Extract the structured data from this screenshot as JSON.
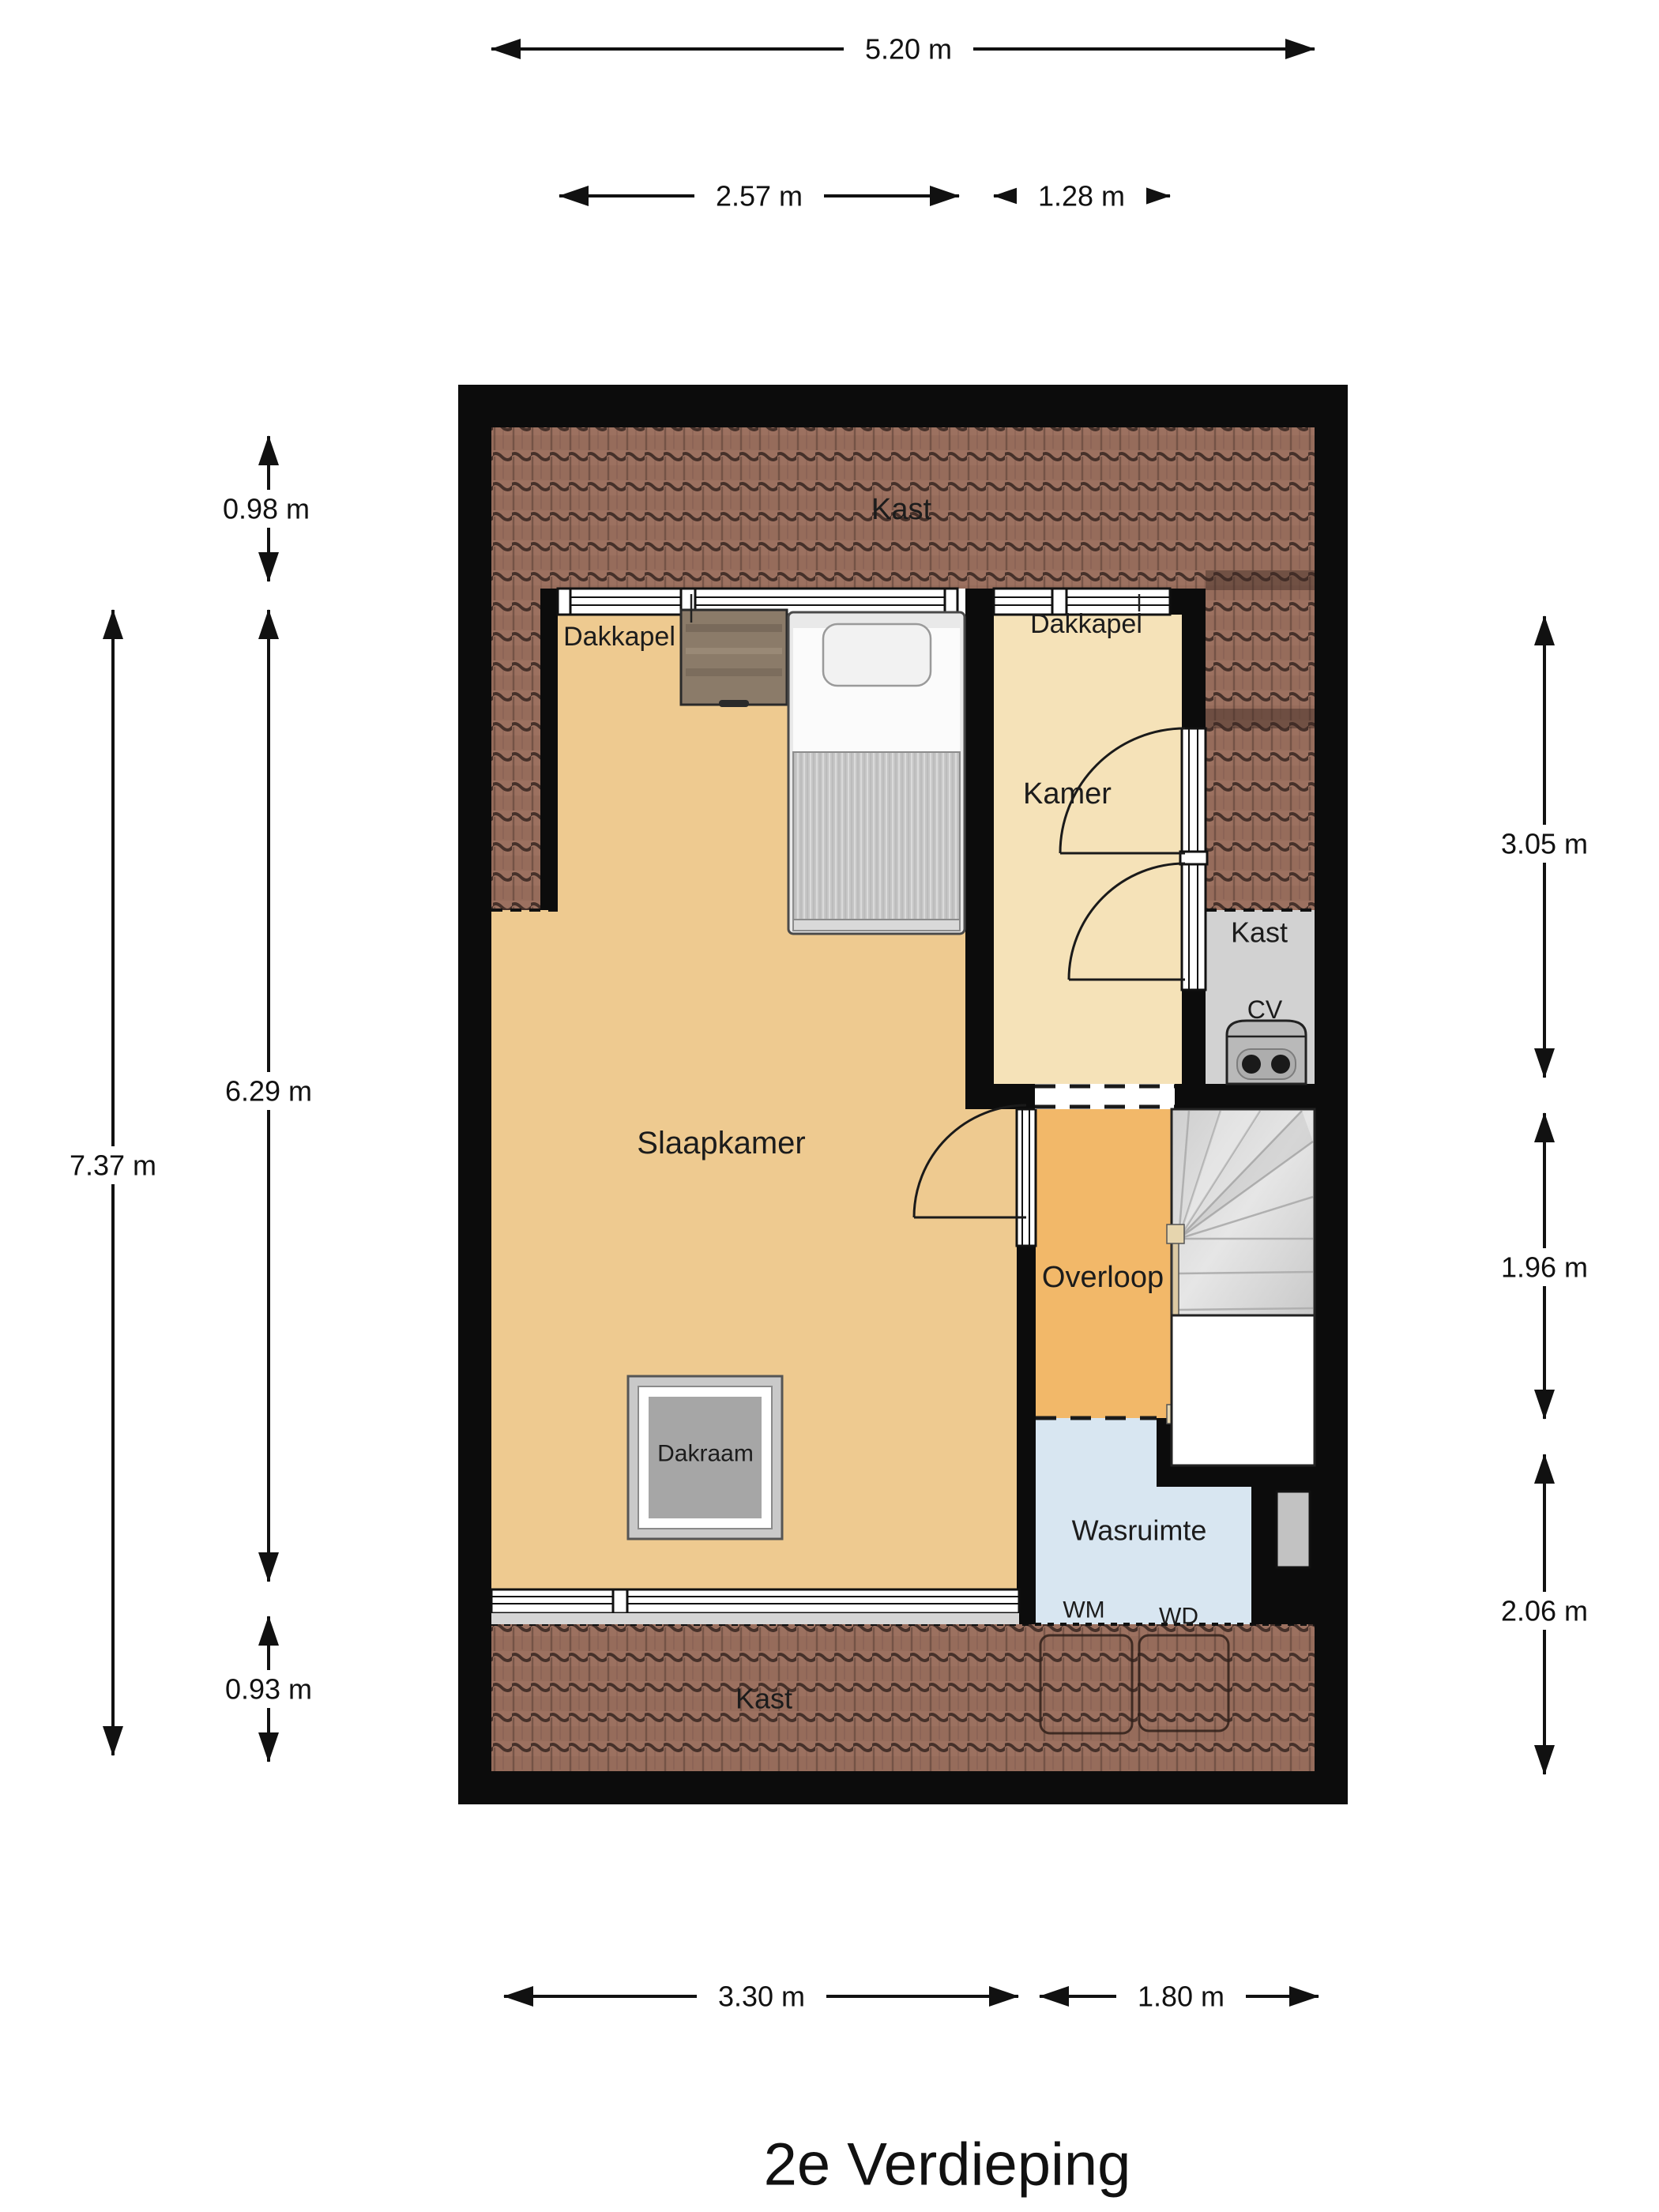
{
  "title": "2e Verdieping",
  "dimensions": {
    "top_total": "5.20 m",
    "top_left_window": "2.57 m",
    "top_right_window": "1.28 m",
    "left_top": "0.98 m",
    "left_outer_total": "7.37 m",
    "left_middle": "6.29 m",
    "left_bottom": "0.93 m",
    "right_top": "3.05 m",
    "right_middle": "1.96 m",
    "right_bottom": "2.06 m",
    "bottom_left": "3.30 m",
    "bottom_right": "1.80 m"
  },
  "rooms": {
    "kast_top": "Kast",
    "dakkapel_left": "Dakkapel",
    "dakkapel_right": "Dakkapel",
    "kamer": "Kamer",
    "kast_cv": "Kast",
    "cv_unit": "CV",
    "slaapkamer": "Slaapkamer",
    "overloop": "Overloop",
    "dakraam": "Dakraam",
    "wasruimte": "Wasruimte",
    "washing_machine": "WM",
    "dryer": "WD",
    "kast_bottom": "Kast"
  },
  "colors": {
    "wall": "#0c0c0c",
    "slaapkamer_floor": "#eeca90",
    "kamer_floor": "#f5e2b8",
    "overloop_floor": "#f2b869",
    "wasruimte_floor": "#d8e6f1",
    "closet_floor": "#d2d2d2",
    "roof_tile_base": "#9c7160",
    "stairs": "#dcdcdc"
  }
}
